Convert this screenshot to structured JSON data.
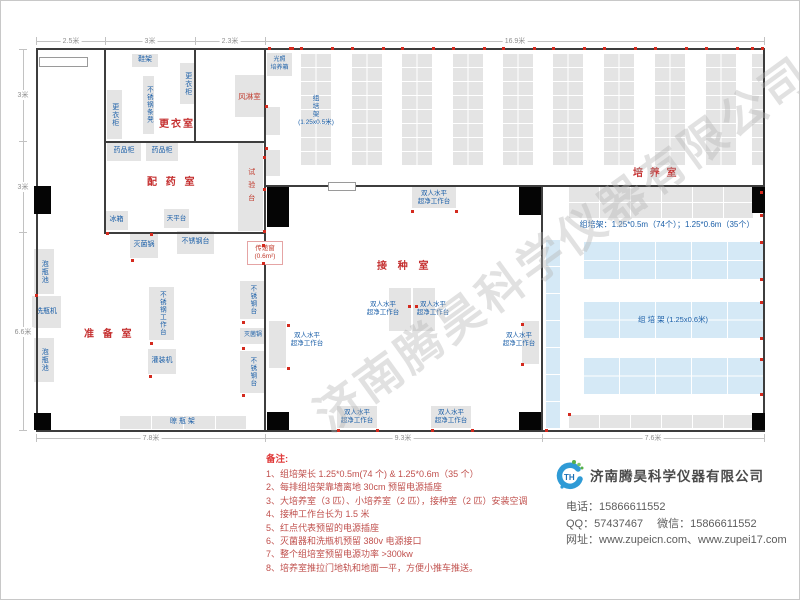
{
  "watermark": {
    "text": "济南腾昊科学仪器有限公司"
  },
  "notes": {
    "title": "备注:",
    "items": [
      "1、组培架长 1.25*0.5m(74 个) & 1.25*0.6m（35 个）",
      "2、每排组培架靠墙离地 30cm 预留电源插座",
      "3、大培养室（3 匹）、小培养室（2 匹），接种室（2 匹）安装空调",
      "4、接种工作台长为 1.5 米",
      "5、红点代表预留的电源插座",
      "6、灭菌器和洗瓶机预留 380v 电源接口",
      "7、整个组培室预留电源功率 >300kw",
      "8、培养室推拉门地轨和地面一平，方便小推车推送。"
    ]
  },
  "company": {
    "logo_text": "TH",
    "name": "济南腾昊科学仪器有限公司",
    "phone_label": "电话：",
    "phone": "15866611552",
    "qq_label": "QQ：",
    "qq": "57437467",
    "wechat_label": "微信：",
    "wechat": "15866611552",
    "web_label": "网址：",
    "websites": "www.zupeicn.com、www.zupei17.com"
  },
  "plan": {
    "walls": [
      {
        "x": 35,
        "y": 47,
        "w": 729,
        "h": 2
      },
      {
        "x": 35,
        "y": 429,
        "w": 729,
        "h": 2
      },
      {
        "x": 35,
        "y": 47,
        "w": 2,
        "h": 384
      },
      {
        "x": 762,
        "y": 47,
        "w": 2,
        "h": 384
      },
      {
        "x": 103,
        "y": 47,
        "w": 2,
        "h": 186
      },
      {
        "x": 193,
        "y": 47,
        "w": 2,
        "h": 95
      },
      {
        "x": 263,
        "y": 47,
        "w": 2,
        "h": 384
      },
      {
        "x": 540,
        "y": 184,
        "w": 2,
        "h": 247
      },
      {
        "x": 103,
        "y": 140,
        "w": 162,
        "h": 2
      },
      {
        "x": 103,
        "y": 231,
        "w": 162,
        "h": 2
      },
      {
        "x": 263,
        "y": 184,
        "w": 501,
        "h": 2
      }
    ],
    "pillars": [
      {
        "x": 33,
        "y": 185,
        "w": 17,
        "h": 28
      },
      {
        "x": 266,
        "y": 186,
        "w": 22,
        "h": 40
      },
      {
        "x": 518,
        "y": 186,
        "w": 22,
        "h": 28
      },
      {
        "x": 751,
        "y": 186,
        "w": 13,
        "h": 26
      },
      {
        "x": 33,
        "y": 412,
        "w": 17,
        "h": 17
      },
      {
        "x": 266,
        "y": 411,
        "w": 22,
        "h": 18
      },
      {
        "x": 518,
        "y": 411,
        "w": 22,
        "h": 18
      },
      {
        "x": 751,
        "y": 412,
        "w": 13,
        "h": 17
      }
    ],
    "openings": [
      {
        "x": 38,
        "y": 56,
        "w": 47,
        "h": 8
      },
      {
        "x": 327,
        "y": 181,
        "w": 26,
        "h": 7
      }
    ],
    "boxes": [
      {
        "name": "shoe-rack",
        "x": 131,
        "y": 53,
        "w": 26,
        "h": 13,
        "label": "鞋架",
        "dir": "h"
      },
      {
        "name": "locker",
        "x": 179,
        "y": 62,
        "w": 15,
        "h": 41,
        "label": "更衣柜",
        "dir": "v"
      },
      {
        "name": "steel-bench",
        "x": 142,
        "y": 75,
        "w": 11,
        "h": 58,
        "label": "不锈钢条凳",
        "dir": "v",
        "fs": 6.5
      },
      {
        "name": "locker",
        "x": 106,
        "y": 89,
        "w": 15,
        "h": 49,
        "label": "更衣柜",
        "dir": "v"
      },
      {
        "name": "air-shower-room",
        "x": 234,
        "y": 74,
        "w": 29,
        "h": 42,
        "label": "风淋室",
        "dir": "h",
        "red": true,
        "fs": 7.5
      },
      {
        "name": "medicine-cabinet",
        "x": 106,
        "y": 141,
        "w": 34,
        "h": 19,
        "label": "药品柜",
        "dir": "h"
      },
      {
        "name": "medicine-cabinet",
        "x": 145,
        "y": 141,
        "w": 32,
        "h": 19,
        "label": "药品柜",
        "dir": "h"
      },
      {
        "name": "test-bench",
        "x": 237,
        "y": 142,
        "w": 25,
        "h": 88,
        "label": "试验台",
        "dir": "v",
        "red": true,
        "ls": 6
      },
      {
        "name": "fridge",
        "x": 104,
        "y": 210,
        "w": 23,
        "h": 19,
        "label": "冰箱",
        "dir": "h"
      },
      {
        "name": "balance-table",
        "x": 163,
        "y": 208,
        "w": 25,
        "h": 19,
        "label": "天平台",
        "dir": "h",
        "fs": 6.5
      },
      {
        "name": "sterilizer",
        "x": 129,
        "y": 232,
        "w": 28,
        "h": 25,
        "label": "灭菌锅",
        "dir": "h"
      },
      {
        "name": "steel-table",
        "x": 176,
        "y": 230,
        "w": 37,
        "h": 23,
        "label": "不锈钢台",
        "dir": "h"
      },
      {
        "name": "soak-pool",
        "x": 33,
        "y": 248,
        "w": 20,
        "h": 45,
        "label": "泡瓶池",
        "dir": "v"
      },
      {
        "name": "bottle-washer",
        "x": 31,
        "y": 295,
        "w": 29,
        "h": 32,
        "label": "洗瓶机",
        "dir": "h"
      },
      {
        "name": "soak-pool",
        "x": 33,
        "y": 337,
        "w": 20,
        "h": 44,
        "label": "泡瓶池",
        "dir": "v"
      },
      {
        "name": "steel-workbench",
        "x": 148,
        "y": 286,
        "w": 25,
        "h": 53,
        "label": "不锈钢工作台",
        "dir": "v",
        "fs": 6.5
      },
      {
        "name": "filling-machine",
        "x": 147,
        "y": 348,
        "w": 28,
        "h": 25,
        "label": "灌装机",
        "dir": "h"
      },
      {
        "name": "steel-table",
        "x": 239,
        "y": 280,
        "w": 24,
        "h": 38,
        "label": "不锈钢台",
        "dir": "v",
        "fs": 6.5
      },
      {
        "name": "sterilizer",
        "x": 239,
        "y": 327,
        "w": 26,
        "h": 16,
        "label": "灭菌锅",
        "dir": "h",
        "fs": 6
      },
      {
        "name": "steel-table",
        "x": 239,
        "y": 350,
        "w": 24,
        "h": 42,
        "label": "不锈钢台",
        "dir": "v",
        "fs": 6.5
      },
      {
        "name": "drying-rack",
        "x": 118,
        "y": 414,
        "w": 127,
        "h": 14,
        "label": "晾  瓶  架",
        "dir": "h",
        "grid": [
          32,
          14
        ]
      },
      {
        "name": "pass-window",
        "x": 246,
        "y": 240,
        "w": 34,
        "h": 22,
        "label": "传递窗/(0.6m²)",
        "dir": "2",
        "red": true,
        "cls": "pass-win",
        "fs": 6.5
      },
      {
        "name": "laminar-flow-bench",
        "x": 411,
        "y": 186,
        "w": 44,
        "h": 21,
        "label": "双人水平/超净工作台",
        "dir": "2",
        "fs": 6.5
      },
      {
        "name": "laminar-flow-bench",
        "x": 388,
        "y": 287,
        "w": 22,
        "h": 43
      },
      {
        "name": "laminar-flow-bench",
        "x": 412,
        "y": 287,
        "w": 22,
        "h": 43
      },
      {
        "name": "laminar-flow-bench",
        "x": 268,
        "y": 320,
        "w": 17,
        "h": 47
      },
      {
        "name": "laminar-flow-bench",
        "x": 521,
        "y": 320,
        "w": 17,
        "h": 43
      },
      {
        "name": "laminar-flow-bench",
        "x": 336,
        "y": 405,
        "w": 40,
        "h": 22,
        "label": "双人水平/超净工作台",
        "dir": "2",
        "fs": 6.5
      },
      {
        "name": "laminar-flow-bench",
        "x": 430,
        "y": 405,
        "w": 40,
        "h": 22,
        "label": "双人水平/超净工作台",
        "dir": "2",
        "fs": 6.5
      },
      {
        "name": "laminar-bench-label",
        "x": 356,
        "y": 299,
        "w": 52,
        "h": 18,
        "label": "双人水平/超净工作台",
        "dir": "2",
        "nobox": true,
        "fs": 6.5
      },
      {
        "name": "laminar-bench-label",
        "x": 406,
        "y": 299,
        "w": 52,
        "h": 18,
        "label": "双人水平/超净工作台",
        "dir": "2",
        "nobox": true,
        "fs": 6.5
      },
      {
        "name": "laminar-bench-label",
        "x": 284,
        "y": 330,
        "w": 44,
        "h": 18,
        "label": "双人水平/超净工作台",
        "dir": "2",
        "nobox": true,
        "fs": 6.5
      },
      {
        "name": "laminar-bench-label",
        "x": 496,
        "y": 330,
        "w": 44,
        "h": 18,
        "label": "双人水平/超净工作台",
        "dir": "2",
        "nobox": true,
        "fs": 6.5
      },
      {
        "name": "light-incubator",
        "x": 266,
        "y": 52,
        "w": 25,
        "h": 23,
        "label": "光照/培养箱",
        "dir": "2",
        "fs": 6
      },
      {
        "name": "cabinet",
        "x": 264,
        "y": 106,
        "w": 15,
        "h": 28
      },
      {
        "name": "cabinet",
        "x": 264,
        "y": 149,
        "w": 15,
        "h": 26
      },
      {
        "name": "culture-shelf-column",
        "x": 299,
        "y": 52,
        "w": 31,
        "h": 112,
        "grid": [
          15.5,
          14
        ]
      },
      {
        "name": "culture-shelf-column",
        "x": 350,
        "y": 52,
        "w": 31,
        "h": 112,
        "grid": [
          15.5,
          14
        ]
      },
      {
        "name": "culture-shelf-column",
        "x": 400,
        "y": 52,
        "w": 31,
        "h": 112,
        "grid": [
          15.5,
          14
        ]
      },
      {
        "name": "culture-shelf-column",
        "x": 451,
        "y": 52,
        "w": 31,
        "h": 112,
        "grid": [
          15.5,
          14
        ]
      },
      {
        "name": "culture-shelf-column",
        "x": 501,
        "y": 52,
        "w": 31,
        "h": 112,
        "grid": [
          15.5,
          14
        ]
      },
      {
        "name": "culture-shelf-column",
        "x": 551,
        "y": 52,
        "w": 31,
        "h": 112,
        "grid": [
          15.5,
          14
        ]
      },
      {
        "name": "culture-shelf-column",
        "x": 602,
        "y": 52,
        "w": 31,
        "h": 112,
        "grid": [
          15.5,
          14
        ]
      },
      {
        "name": "culture-shelf-column",
        "x": 653,
        "y": 52,
        "w": 31,
        "h": 112,
        "grid": [
          15.5,
          14
        ]
      },
      {
        "name": "culture-shelf-column",
        "x": 704,
        "y": 52,
        "w": 31,
        "h": 112,
        "grid": [
          15.5,
          14
        ]
      },
      {
        "name": "culture-shelf-column",
        "x": 750,
        "y": 52,
        "w": 12,
        "h": 112,
        "grid": [
          15.5,
          14
        ]
      },
      {
        "name": "culture-shelf-label",
        "x": 294,
        "y": 86,
        "w": 42,
        "h": 48,
        "label": "组/培/架/(1.25x0.5米)",
        "dir": "2",
        "nobox": true,
        "fs": 6.5
      },
      {
        "name": "shelf-row",
        "x": 567,
        "y": 185,
        "w": 185,
        "h": 32,
        "grid": [
          31,
          16
        ]
      },
      {
        "name": "shelf-spec-label",
        "x": 568,
        "y": 218,
        "w": 196,
        "h": 12,
        "label": "组培架：1.25*0.5m（74个）；1.25*0.6m（35个）",
        "dir": "h",
        "nobox": true,
        "fs": 8
      },
      {
        "name": "shelf-column-blue",
        "x": 544,
        "y": 238,
        "w": 15,
        "h": 190,
        "blue": true,
        "grid": [
          15,
          27
        ]
      },
      {
        "name": "shelf-row-blue",
        "x": 582,
        "y": 240,
        "w": 180,
        "h": 38,
        "blue": true,
        "grid": [
          36,
          19
        ]
      },
      {
        "name": "shelf-row-blue",
        "x": 582,
        "y": 300,
        "w": 180,
        "h": 37,
        "blue": true,
        "grid": [
          36,
          18.5
        ],
        "label": "组  培  架 (1.25x0.6米)",
        "dir": "h",
        "fs": 7.5
      },
      {
        "name": "shelf-row-blue",
        "x": 582,
        "y": 356,
        "w": 180,
        "h": 37,
        "blue": true,
        "grid": [
          36,
          18.5
        ]
      },
      {
        "name": "shelf-row",
        "x": 567,
        "y": 413,
        "w": 185,
        "h": 14,
        "grid": [
          31,
          14
        ]
      }
    ],
    "room_labels": [
      {
        "id": "changing-room",
        "x": 158,
        "y": 114,
        "text": "更衣室",
        "ls": 2
      },
      {
        "id": "dispensing-room",
        "x": 146,
        "y": 172,
        "text": "配 药 室",
        "ls": 3
      },
      {
        "id": "preparation-room",
        "x": 83,
        "y": 324,
        "text": "准 备 室",
        "ls": 3
      },
      {
        "id": "inoculation-room",
        "x": 376,
        "y": 256,
        "text": "接 种 室",
        "ls": 4
      },
      {
        "id": "culture-room",
        "x": 632,
        "y": 163,
        "text": "培 养 室",
        "ls": 2
      }
    ],
    "dim_lines": [
      {
        "x": 35,
        "y": 40,
        "w": 729,
        "h": 1
      },
      {
        "x": 35,
        "y": 36,
        "w": 1,
        "h": 8
      },
      {
        "x": 104,
        "y": 36,
        "w": 1,
        "h": 8
      },
      {
        "x": 194,
        "y": 36,
        "w": 1,
        "h": 8
      },
      {
        "x": 264,
        "y": 36,
        "w": 1,
        "h": 8
      },
      {
        "x": 763,
        "y": 36,
        "w": 1,
        "h": 8
      },
      {
        "x": 22,
        "y": 48,
        "w": 1,
        "h": 382
      },
      {
        "x": 18,
        "y": 48,
        "w": 8,
        "h": 1
      },
      {
        "x": 18,
        "y": 140,
        "w": 8,
        "h": 1
      },
      {
        "x": 18,
        "y": 231,
        "w": 8,
        "h": 1
      },
      {
        "x": 18,
        "y": 429,
        "w": 8,
        "h": 1
      },
      {
        "x": 35,
        "y": 437,
        "w": 729,
        "h": 1
      },
      {
        "x": 35,
        "y": 433,
        "w": 1,
        "h": 8
      },
      {
        "x": 264,
        "y": 433,
        "w": 1,
        "h": 8
      },
      {
        "x": 541,
        "y": 433,
        "w": 1,
        "h": 8
      },
      {
        "x": 763,
        "y": 433,
        "w": 1,
        "h": 8
      }
    ],
    "dim_labels": [
      {
        "x": 70,
        "y": 40,
        "text": "2.5米"
      },
      {
        "x": 149,
        "y": 40,
        "text": "3米"
      },
      {
        "x": 229,
        "y": 40,
        "text": "2.3米"
      },
      {
        "x": 514,
        "y": 40,
        "text": "16.9米"
      },
      {
        "x": 22,
        "y": 94,
        "text": "3米"
      },
      {
        "x": 22,
        "y": 186,
        "text": "3米"
      },
      {
        "x": 22,
        "y": 331,
        "text": "6.6米"
      },
      {
        "x": 150,
        "y": 437,
        "text": "7.8米"
      },
      {
        "x": 402,
        "y": 437,
        "text": "9.3米"
      },
      {
        "x": 652,
        "y": 437,
        "text": "7.6米"
      }
    ],
    "red_dots": [
      [
        288,
        46
      ],
      [
        299,
        46
      ],
      [
        330,
        46
      ],
      [
        350,
        46
      ],
      [
        381,
        46
      ],
      [
        400,
        46
      ],
      [
        431,
        46
      ],
      [
        451,
        46
      ],
      [
        482,
        46
      ],
      [
        501,
        46
      ],
      [
        532,
        46
      ],
      [
        551,
        46
      ],
      [
        582,
        46
      ],
      [
        602,
        46
      ],
      [
        633,
        46
      ],
      [
        653,
        46
      ],
      [
        684,
        46
      ],
      [
        704,
        46
      ],
      [
        735,
        46
      ],
      [
        750,
        46
      ],
      [
        760,
        46
      ],
      [
        267,
        46
      ],
      [
        290,
        46
      ],
      [
        759,
        190
      ],
      [
        759,
        213
      ],
      [
        759,
        240
      ],
      [
        759,
        277
      ],
      [
        759,
        300
      ],
      [
        759,
        336
      ],
      [
        759,
        357
      ],
      [
        759,
        392
      ],
      [
        34,
        293
      ],
      [
        262,
        155
      ],
      [
        262,
        187
      ],
      [
        262,
        229
      ],
      [
        149,
        232
      ],
      [
        105,
        231
      ],
      [
        130,
        258
      ],
      [
        149,
        341
      ],
      [
        148,
        374
      ],
      [
        241,
        320
      ],
      [
        241,
        346
      ],
      [
        241,
        393
      ],
      [
        261,
        243
      ],
      [
        261,
        261
      ],
      [
        410,
        209
      ],
      [
        454,
        209
      ],
      [
        407,
        304
      ],
      [
        414,
        304
      ],
      [
        286,
        323
      ],
      [
        286,
        366
      ],
      [
        520,
        322
      ],
      [
        520,
        362
      ],
      [
        336,
        428
      ],
      [
        375,
        428
      ],
      [
        430,
        428
      ],
      [
        470,
        428
      ],
      [
        544,
        428
      ],
      [
        567,
        412
      ],
      [
        264,
        104
      ],
      [
        264,
        146
      ]
    ]
  }
}
